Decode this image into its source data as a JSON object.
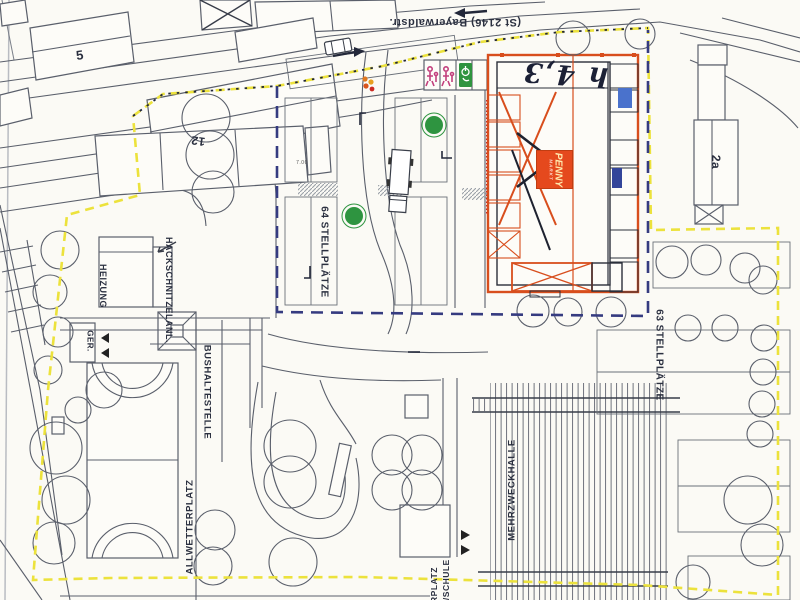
{
  "labels": {
    "street": "(St 2146)  Bayerwaldstr.",
    "building_5": "5",
    "building_12": "12",
    "building_2a": "2a",
    "hackschnitzelanlage": "HACKSCHNITZELANL.",
    "heizung": "HEIZUNG",
    "geraete": "GER.",
    "bushaltestelle": "BUSHALTESTELLE",
    "allwetterplatz": "ALLWETTERPLATZ",
    "stellplaetze_64": "64 STELLPLÄTZE",
    "stellplaetze_63": "63 STELLPLÄTZE",
    "mehrzweckhalle": "MEHRZWECKHALLE",
    "schule_partial_1": "RPLATZ",
    "schule_partial_2": "H/SCHULE",
    "handwritten_height": "h 4,3",
    "dimension": "7.00"
  },
  "penny": {
    "logo": "PENNY",
    "logo_sub": "MARKT"
  },
  "icons": {
    "family_parking": "parent-child-parking-icon",
    "disabled_parking": "wheelchair-parking-icon",
    "playground_marker": "orange-cluster-icon",
    "trees": "tree-canopy-circle",
    "truck": "delivery-truck",
    "car": "car",
    "road_arrows": "road-direction-arrows"
  },
  "colors": {
    "paper": "#fbfaf5",
    "line": "#5a5f6b",
    "line_dark": "#383d49",
    "boundary_yellow": "#ece23c",
    "boundary_navy": "#353b80",
    "penny_orange": "#d84e1d",
    "penny_logo_bg": "#e5491d",
    "penny_logo_text": "#ffe9ae",
    "tree_green": "#2e9440",
    "magenta_icon": "#c23f7d",
    "disabled_green": "#2f9440",
    "crosswalk_gray": "#9aa0a8",
    "ink": "#2b3040",
    "red_note": "#cc2a22"
  }
}
